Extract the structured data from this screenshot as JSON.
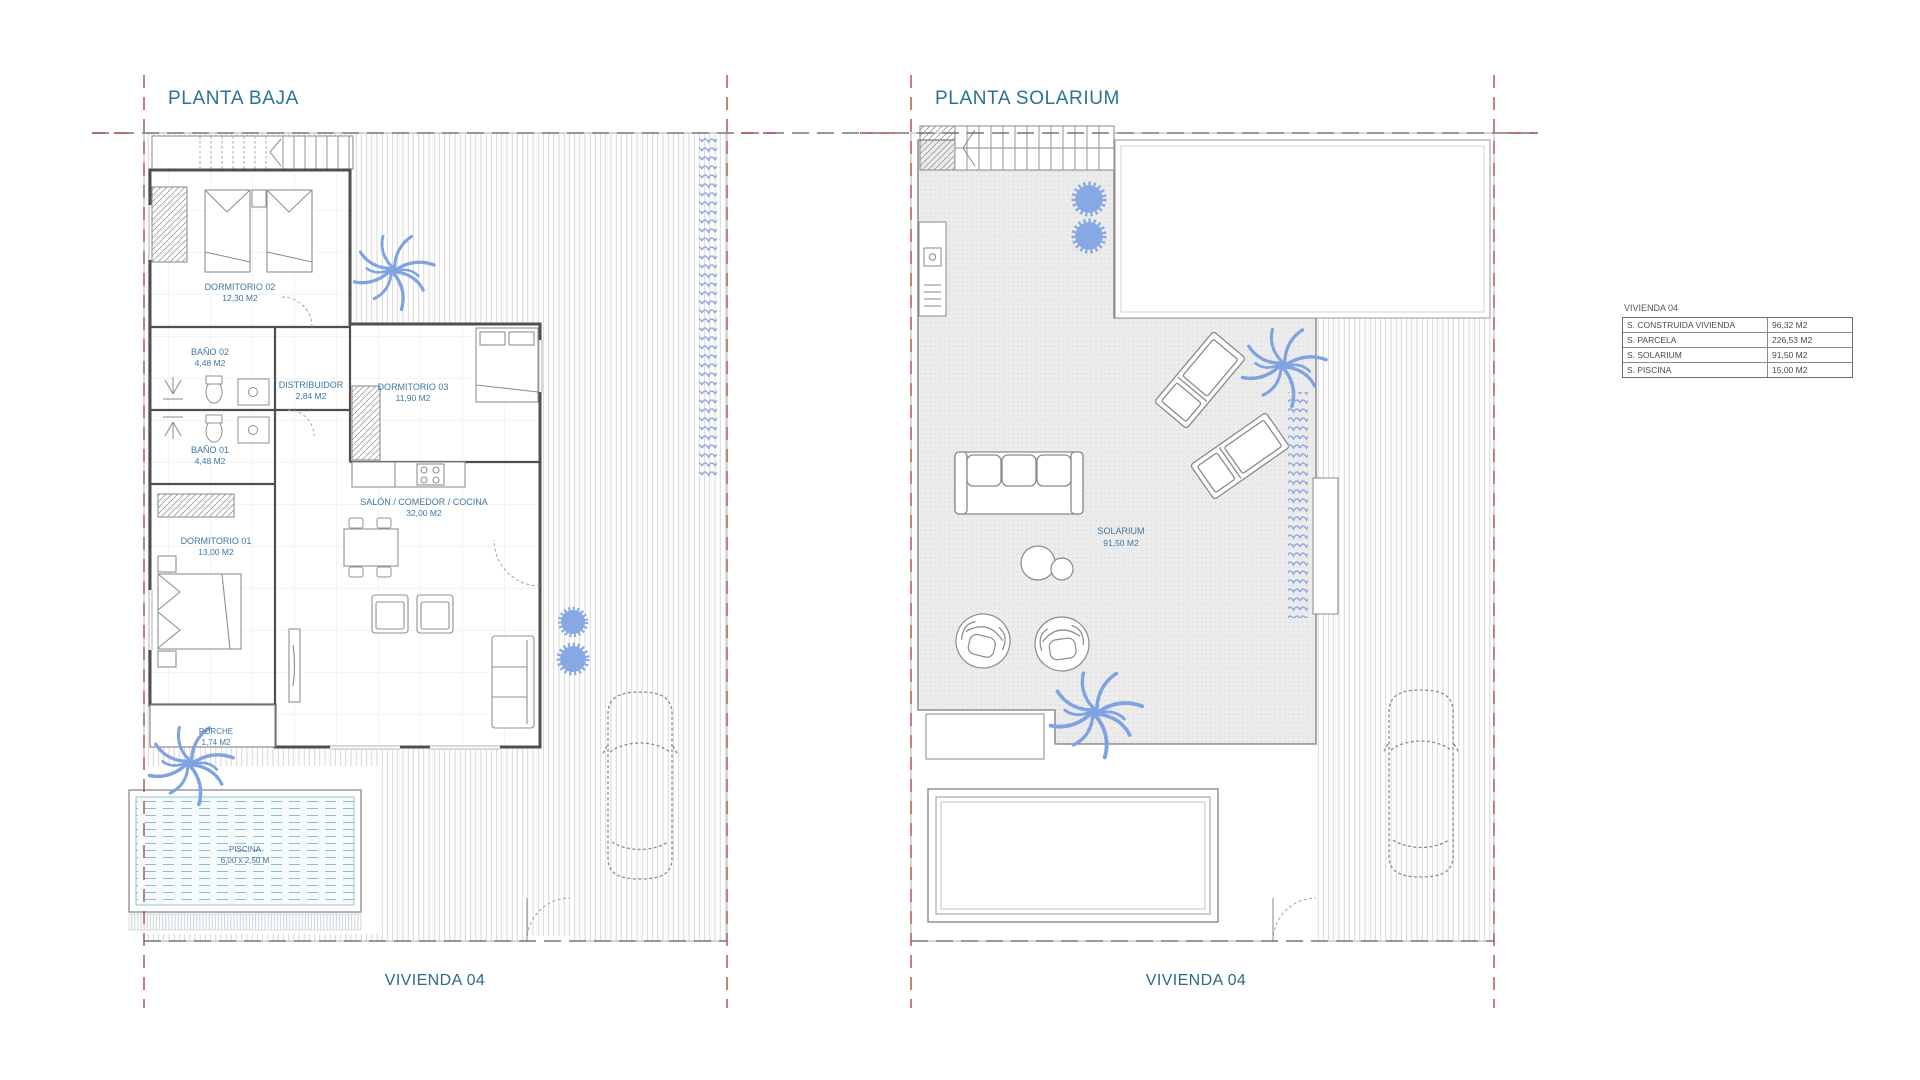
{
  "page": {
    "background": "#ffffff"
  },
  "colors": {
    "title_blue": "#2b7295",
    "label_blue": "#4077a3",
    "boundary_red": "#a84c42",
    "wall_gray": "#4f4f4f",
    "plant_blue": "#7fa3e2",
    "pool_teal": "#93bccb",
    "table_text": "#4a4a4a"
  },
  "left_plan": {
    "title": "PLANTA BAJA",
    "footer": "VIVIENDA 04",
    "rooms": {
      "dormitorio02": {
        "name": "DORMITORIO 02",
        "area": "12,30 M2"
      },
      "bano02": {
        "name": "BAÑO 02",
        "area": "4,48 M2"
      },
      "bano01": {
        "name": "BAÑO 01",
        "area": "4,48 M2"
      },
      "distribuidor": {
        "name": "DISTRIBUIDOR",
        "area": "2,84 M2"
      },
      "dormitorio03": {
        "name": "DORMITORIO 03",
        "area": "11,90 M2"
      },
      "salon": {
        "name": "SALÓN / COMEDOR / COCINA",
        "area": "32,00 M2"
      },
      "dormitorio01": {
        "name": "DORMITORIO 01",
        "area": "13,00 M2"
      },
      "porche": {
        "name": "PORCHE",
        "area": "1,74 M2"
      },
      "piscina": {
        "name": "PISCINA",
        "dimensions": "6,00 x 2,50 M"
      }
    }
  },
  "right_plan": {
    "title": "PLANTA SOLARIUM",
    "footer": "VIVIENDA 04",
    "rooms": {
      "solarium": {
        "name": "SOLARIUM",
        "area": "91,50 M2"
      }
    }
  },
  "summary_table": {
    "title": "VIVIENDA 04",
    "rows": [
      {
        "label": "S. CONSTRUIDA VIVIENDA",
        "value": "96,32 M2"
      },
      {
        "label": "S. PARCELA",
        "value": "226,53 M2"
      },
      {
        "label": "S. SOLARIUM",
        "value": "91,50 M2"
      },
      {
        "label": "S. PISCINA",
        "value": "15,00 M2"
      }
    ]
  }
}
